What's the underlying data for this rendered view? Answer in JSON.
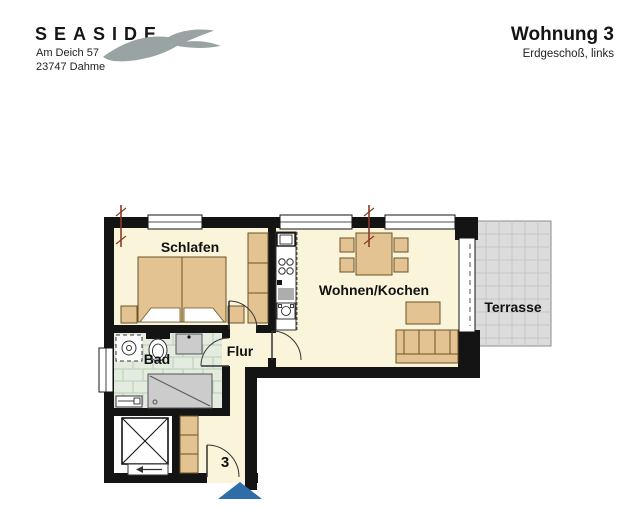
{
  "header": {
    "brand": "SEASIDE",
    "address_line1": "Am Deich 57",
    "address_line2": "23747 Dahme",
    "title": "Wohnung 3",
    "subtitle": "Erdgeschoß, links"
  },
  "floorplan": {
    "rooms": {
      "bedroom_label": "Schlafen",
      "living_label": "Wohnen/Kochen",
      "bath_label": "Bad",
      "hall_label": "Flur",
      "terrace_label": "Terrasse"
    },
    "entrance_number": "3"
  },
  "colors": {
    "wall": "#141414",
    "floor": "#f9f4da",
    "furniture": "#e4c392",
    "furniture_border": "#6b5327",
    "terrace_fill": "#dcdcdc",
    "terrace_grid": "#c6c6c6",
    "tile_fill": "#e3ecdf",
    "tile_line": "#b9cdb8",
    "fixture_gray": "#cccccc",
    "entrance_arrow": "#2e6da8",
    "section_marker": "#8c3b2a",
    "seagull": "#9aa3a3"
  }
}
